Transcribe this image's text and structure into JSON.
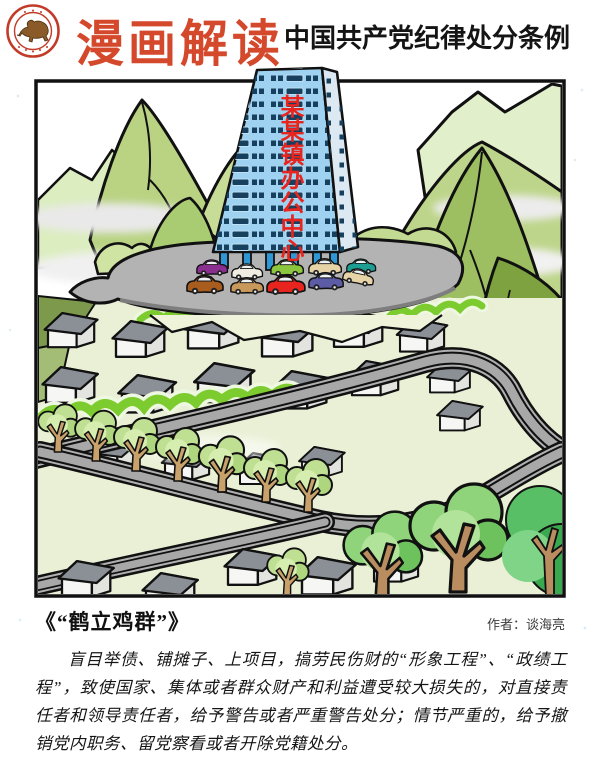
{
  "header": {
    "logo": "bull-seal-emblem",
    "title": "漫画解读",
    "subtitle": "中国共产党纪律处分条例"
  },
  "cartoon": {
    "building_sign": "某某镇办公中心",
    "scene": "tall blue office tower on hilltop parking plateau, surrounded by mountains, village houses, winding roads and trees"
  },
  "caption": {
    "title": "《“鹤立鸡群”》",
    "author": "作者：谈海亮"
  },
  "body": {
    "paragraph": "盲目举债、铺摊子、上项目，搞劳民伤财的“形象工程”、“政绩工程”，致使国家、集体或者群众财产和利益遭受较大损失的，对直接责任者和领导责任者，给予警告或者严重警告处分；情节严重的，给予撤销党内职务、留党察看或者开除党籍处分。"
  },
  "colors": {
    "accent_red": "#d4492c",
    "sign_red": "#e8241f",
    "building_blue": "#9fd2f0",
    "frame_black": "#111111"
  }
}
